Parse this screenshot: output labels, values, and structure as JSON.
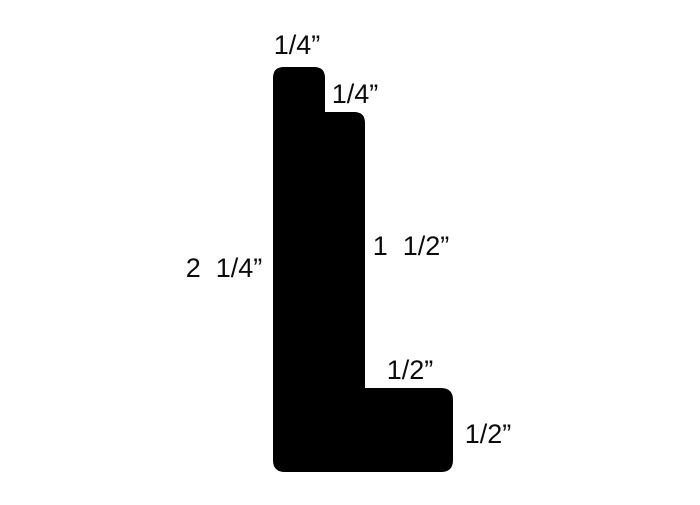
{
  "diagram": {
    "type": "moulding-profile-cross-section",
    "shape_color": "#000000",
    "background_color": "#ffffff",
    "text_color": "#0b0b0b",
    "labels": {
      "top_step_width": "1/4”",
      "second_step_width": "1/4”",
      "leg_height": "1  1/2”",
      "total_height": "2  1/4”",
      "foot_extension_width": "1/2”",
      "foot_height": "1/2”"
    },
    "dimensions_in_inches": {
      "top_step_width": 0.25,
      "second_step_width": 0.25,
      "leg_height": 1.5,
      "total_height": 2.25,
      "foot_extension_width": 0.5,
      "foot_height": 0.5
    }
  }
}
